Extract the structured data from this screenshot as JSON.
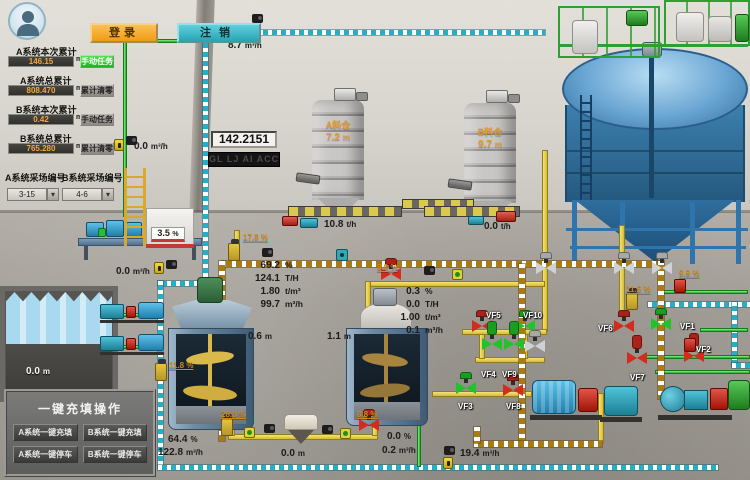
{
  "header": {
    "login_label": "登录",
    "logout_label": "注销"
  },
  "left_panel": {
    "fields": [
      {
        "label": "A系统本次累计",
        "value": "146.15",
        "unit": "m³",
        "button": "手动任务",
        "style": "green"
      },
      {
        "label": "A系统总累计",
        "value": "808.470",
        "unit": "m³",
        "button": "累计清零",
        "style": "gray"
      },
      {
        "label": "B系统本次累计",
        "value": "0.42",
        "unit": "m³",
        "button": "手动任务",
        "style": "gray"
      },
      {
        "label": "B系统总累计",
        "value": "765.280",
        "unit": "m³",
        "button": "累计清零",
        "style": "gray"
      }
    ],
    "selectors": [
      {
        "label": "A系统采场编号",
        "value": "3-15"
      },
      {
        "label": "B系统采场编号",
        "value": "4-6"
      }
    ]
  },
  "display": {
    "value": "142.2151",
    "marquee": "GL LJ AI ACC"
  },
  "tank_badge": {
    "v": "3.5",
    "u": "%"
  },
  "silos": [
    {
      "name": "A料仓",
      "level": "7.2",
      "unit": "m"
    },
    {
      "name": "B料仓",
      "level": "9.7",
      "unit": "m"
    }
  ],
  "blocks": {
    "a": [
      {
        "v": "69.2",
        "u": "%"
      },
      {
        "v": "124.1",
        "u": "T/H"
      },
      {
        "v": "1.80",
        "u": "t/m³"
      },
      {
        "v": "99.7",
        "u": "m³/h"
      }
    ],
    "b": [
      {
        "v": "0.3",
        "u": "%"
      },
      {
        "v": "0.0",
        "u": "T/H"
      },
      {
        "v": "1.00",
        "u": "t/m³"
      },
      {
        "v": "0.1",
        "u": "m³/h"
      }
    ]
  },
  "meters": [
    {
      "id": "flow_top",
      "v": "8.7",
      "u": "m³/h"
    },
    {
      "id": "flow_left_upper",
      "v": "0.0",
      "u": "m³/h"
    },
    {
      "id": "flow_left_mid",
      "v": "0.0",
      "u": "m³/h"
    },
    {
      "id": "conveyor_a",
      "v": "10.8",
      "u": "t/h"
    },
    {
      "id": "conveyor_b",
      "v": "0.0",
      "u": "t/h"
    },
    {
      "id": "mixer1_level",
      "v": "0.6",
      "u": "m"
    },
    {
      "id": "mixer2_level",
      "v": "1.1",
      "u": "m"
    },
    {
      "id": "hopper_level",
      "v": "0.0",
      "u": "m"
    },
    {
      "id": "pool_level",
      "v": "0.0",
      "u": "m"
    },
    {
      "id": "b_row_pct",
      "v": "0.0",
      "u": "%"
    },
    {
      "id": "b_row_flow",
      "v": "0.2",
      "u": "m³/h"
    },
    {
      "id": "teal_pct",
      "v": "64.4",
      "u": "%"
    },
    {
      "id": "teal_flow",
      "v": "122.8",
      "u": "m³/h"
    },
    {
      "id": "flow_bottom_right",
      "v": "19.4",
      "u": "m³/h"
    }
  ],
  "percent_labels": [
    {
      "id": "pv1",
      "text": "17.8 %"
    },
    {
      "id": "pv2",
      "text": "8.8 %"
    },
    {
      "id": "pv3",
      "text": "11.8 %"
    },
    {
      "id": "pv4",
      "text": "28.8 %"
    },
    {
      "id": "pv5",
      "text": "8.8 %"
    },
    {
      "id": "pv6",
      "text": "11.5 %"
    },
    {
      "id": "pv7",
      "text": "9.9 %"
    }
  ],
  "valves": [
    {
      "tag": "VF5",
      "state": "red"
    },
    {
      "tag": "VF10",
      "state": "green"
    },
    {
      "tag": "VF4",
      "state": "green"
    },
    {
      "tag": "VF9",
      "state": "green"
    },
    {
      "tag": "VF3",
      "state": "green"
    },
    {
      "tag": "VF8",
      "state": "red"
    },
    {
      "tag": "VF6",
      "state": "red"
    },
    {
      "tag": "VF1",
      "state": "green"
    },
    {
      "tag": "VF2",
      "state": "red"
    },
    {
      "tag": "VF7",
      "state": "red"
    }
  ],
  "panel": {
    "title": "一键充填操作",
    "buttons": [
      "A系统一键充填",
      "B系统一键充填",
      "A系统一键停车",
      "B系统一键停车"
    ]
  },
  "colors": {
    "accent_orange": "#f0a226",
    "accent_teal": "#3bbdc9",
    "pipe_teal": "#26aec6",
    "pipe_brown": "#a87b16",
    "pipe_yellow": "#e9d34c",
    "pipe_green": "#35d23c",
    "valve_red": "#d42b1f",
    "valve_green": "#22c32a",
    "value_orange": "#f5a83a"
  }
}
